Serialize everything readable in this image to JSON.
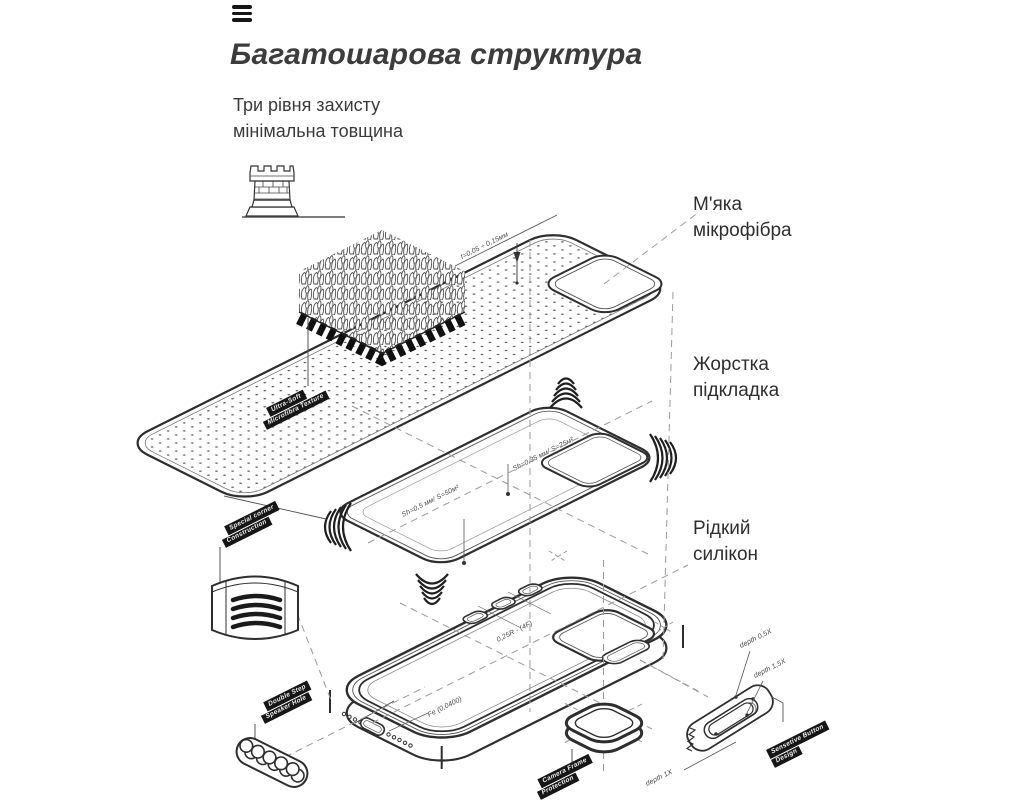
{
  "header": {
    "title": "Багатошарова структура",
    "subtitle": [
      "Три рівня захисту",
      "мінімальна товщина"
    ]
  },
  "feature_labels": [
    {
      "lines": [
        "М'яка",
        "мікрофібра"
      ]
    },
    {
      "lines": [
        "Жорстка",
        "підкладка"
      ]
    },
    {
      "lines": [
        "Рідкий",
        "силікон"
      ]
    }
  ],
  "diagram": {
    "annotations": {
      "microfiber_thickness": "t=0,05 ÷ 0,15мм",
      "shell_top": "Sh=0,35 мм/ S=25м²",
      "shell_bottom": "Sh=0,5 мм/ S=50м²",
      "button_radius": "0,25R - (4F)",
      "fe": "Fe (0,0400)",
      "depth_05": "depth 0,5X",
      "depth_15": "depth 1,5X",
      "depth_1": "depth 1X"
    },
    "tags": {
      "ultra_soft": [
        "Ultra-Soft",
        "Microfibra Texture"
      ],
      "special_corner": [
        "Special corner",
        "Construction"
      ],
      "double_step": [
        "Double Step",
        "Speaker Hole"
      ],
      "camera_frame": [
        "Camera Frame",
        "Protection"
      ],
      "sensetive_button": [
        "Sensetive Button",
        "Design"
      ]
    }
  },
  "colors": {
    "ink": "#2e2e2e",
    "text": "#3c3c3c",
    "tag_bg": "#161616"
  }
}
